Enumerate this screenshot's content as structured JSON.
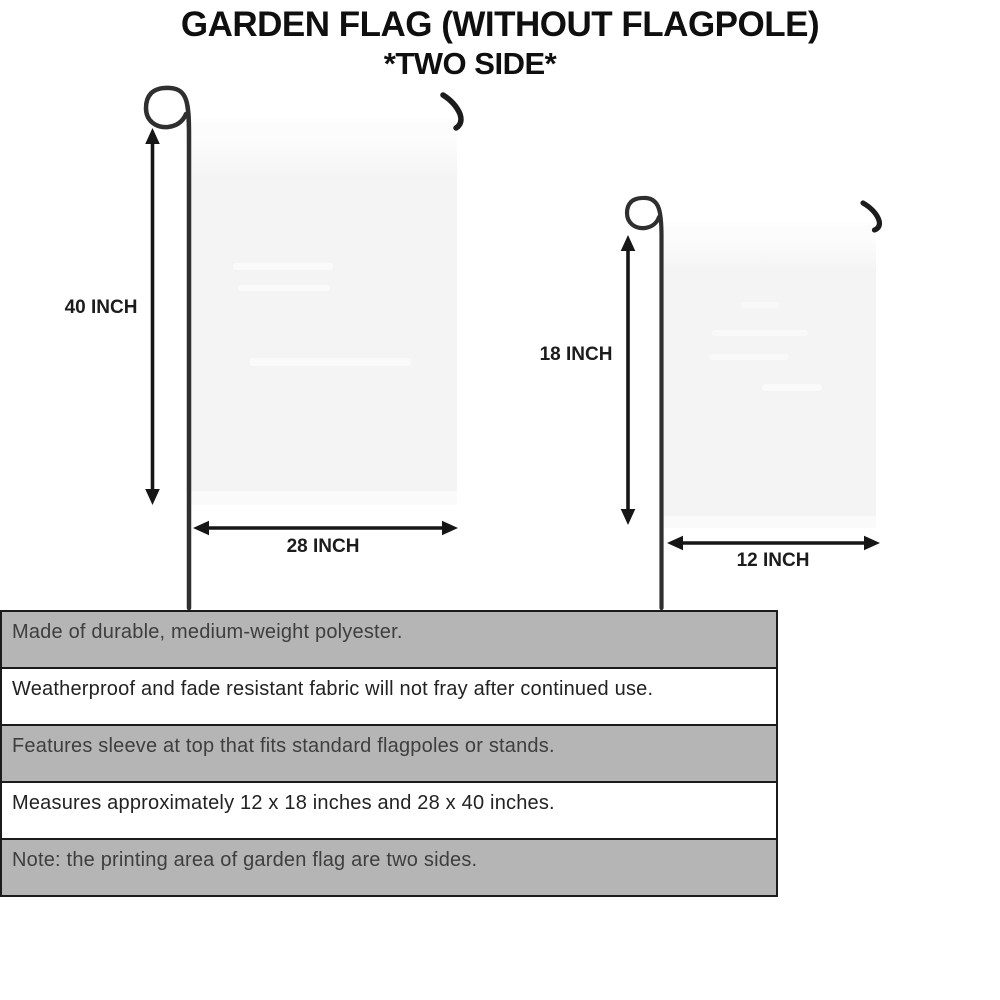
{
  "title": {
    "line1": "GARDEN FLAG (WITHOUT FLAGPOLE)",
    "line2": "*TWO SIDE*"
  },
  "diagram": {
    "large_flag": {
      "name": "large garden flag",
      "height_label": "40 INCH",
      "width_label": "28 INCH"
    },
    "small_flag": {
      "name": "small garden flag",
      "height_label": "18 INCH",
      "width_label": "12 INCH"
    }
  },
  "features": [
    {
      "text": "Made of durable, medium-weight polyester.",
      "highlighted": true
    },
    {
      "text": "Weatherproof and fade resistant fabric will not fray after continued use.",
      "highlighted": false
    },
    {
      "text": "Features sleeve at top that fits standard flagpoles or stands.",
      "highlighted": true
    },
    {
      "text": "Measures approximately 12 x 18 inches and 28 x 40 inches.",
      "highlighted": false
    },
    {
      "text": "Note: the printing area of garden flag are two sides.",
      "highlighted": true
    }
  ],
  "colors": {
    "background": "#ffffff",
    "title_text": "#0f0f0f",
    "row_highlight_gray": "#b5b5b5",
    "row_border_black": "#1b1b1b",
    "flag_fill": "#f5f5f5",
    "pole_dark": "#2f2f2f",
    "arrow_black": "#161616"
  }
}
